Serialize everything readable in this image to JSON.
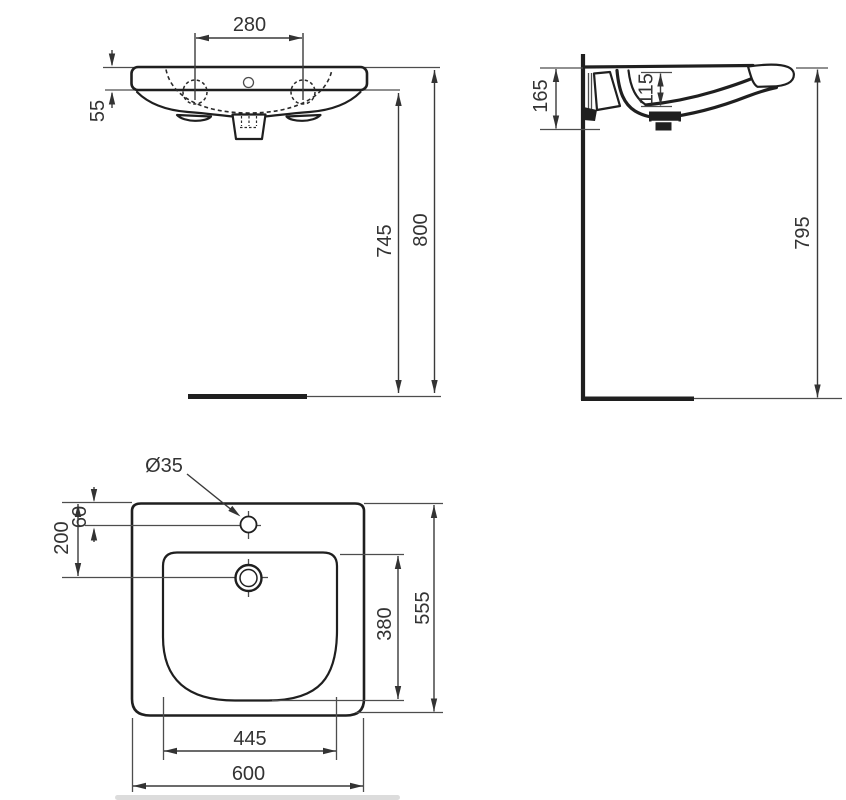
{
  "colors": {
    "line": "#1f1f1f",
    "thin_line": "#4d4d4d",
    "text": "#333333",
    "background": "#ffffff"
  },
  "front_view": {
    "tap_hole_spacing": "280",
    "rim_height": "55",
    "height_to_underside": "745",
    "height_overall": "800"
  },
  "side_view": {
    "depth_at_wall": "165",
    "bowl_depth": "115",
    "height_to_rim": "795"
  },
  "plan_view": {
    "tap_hole_diameter": "Ø35",
    "tap_hole_offset": "60",
    "drain_offset": "200",
    "bowl_inner_depth": "380",
    "overall_depth": "555",
    "bowl_inner_width": "445",
    "overall_width": "600"
  }
}
